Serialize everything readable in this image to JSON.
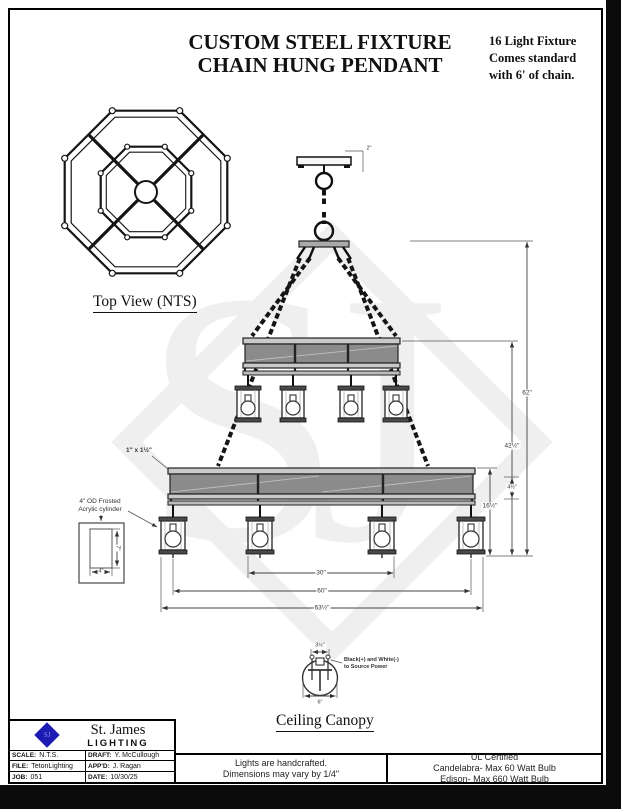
{
  "header": {
    "title1": "CUSTOM STEEL FIXTURE",
    "title2": "CHAIN HUNG PENDANT",
    "note1": "16 Light Fixture",
    "note2": "Comes standard",
    "note3": "with 6' of chain."
  },
  "labels": {
    "top_view": "Top View (NTS)",
    "ceiling_canopy": "Ceiling Canopy"
  },
  "annotations": {
    "steel_size": "1\" x 1½\"",
    "cyl_note1": "4\" OD Frosted",
    "cyl_note2": "Acrylic cylinder",
    "wiring1": "Black(+) and White(-)",
    "wiring2": "to Source Power"
  },
  "dimensions": {
    "overall_height": "62\"",
    "upper_band_to_bottom": "42½\"",
    "lower_tier_height": "16½\"",
    "band_face": "4½\"",
    "canopy_edge": "2\"",
    "inner_width": "30\"",
    "mid_width": "60\"",
    "overall_width": "63½\"",
    "cyl_height": "7\"",
    "cyl_width": "4\"",
    "canopy_bracket_width": "3½\"",
    "canopy_width": "6\""
  },
  "watermark": "SJ",
  "title_block": {
    "logo_text": "SJ",
    "company": "St. James",
    "division": "LIGHTING",
    "scale_label": "SCALE:",
    "scale": "N.T.S.",
    "draft_label": "DRAFT:",
    "draft": "Y. McCullough",
    "file_label": "FILE:",
    "file": "TetonLighting",
    "appd_label": "APP'D:",
    "appd": "J. Ragan",
    "job_label": "JOB:",
    "job": "051",
    "date_label": "DATE:",
    "date": "10/30/25"
  },
  "footer": {
    "center1": "Lights are handcrafted.",
    "center2": "Dimensions may vary by 1/4\"",
    "right1": "UL Certified",
    "right2": "Candelabra- Max 60 Watt Bulb",
    "right3": "Edison- Max 660 Watt Bulb"
  },
  "colors": {
    "logo_blue": "#1c1cb4",
    "band_gray": "#8b8b8b",
    "line": "#1a1a1a",
    "watermark_gray": "#efefef"
  }
}
